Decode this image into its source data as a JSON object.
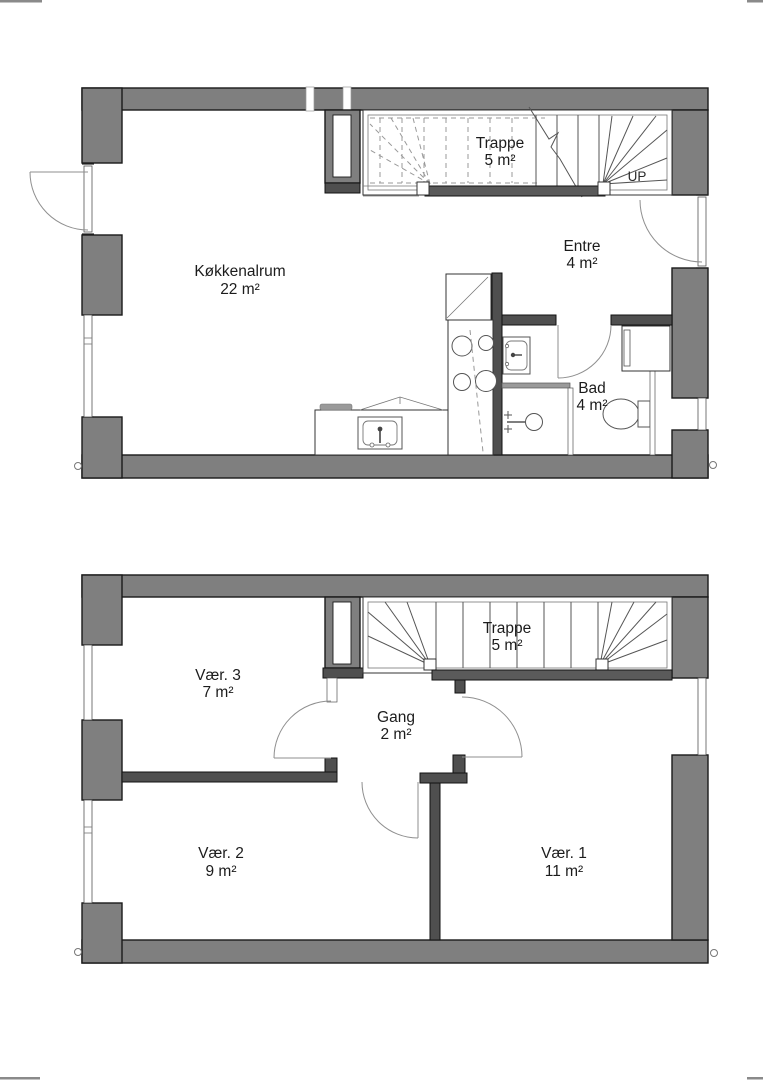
{
  "document": {
    "type": "architectural-floor-plan",
    "background": "#ffffff",
    "crop_mark_color": "#8a8a8a"
  },
  "palette": {
    "outer_wall_fill": "#7f7f7f",
    "interior_wall_fill": "#4f4f4f",
    "outline": "#1a1a1a",
    "light_line": "#8f8f8f",
    "text": "#1c1c1c"
  },
  "plans": [
    {
      "id": "ground-floor",
      "rooms": [
        {
          "name": "Køkkenalrum",
          "area": "22 m²"
        },
        {
          "name": "Trappe",
          "area": "5 m²"
        },
        {
          "name": "Entre",
          "area": "4 m²"
        },
        {
          "name": "Bad",
          "area": "4 m²"
        }
      ],
      "stair_direction_label": "UP"
    },
    {
      "id": "upper-floor",
      "rooms": [
        {
          "name": "Vær. 3",
          "area": "7 m²"
        },
        {
          "name": "Trappe",
          "area": "5 m²"
        },
        {
          "name": "Gang",
          "area": "2 m²"
        },
        {
          "name": "Vær. 2",
          "area": "9 m²"
        },
        {
          "name": "Vær. 1",
          "area": "11 m²"
        }
      ]
    }
  ]
}
